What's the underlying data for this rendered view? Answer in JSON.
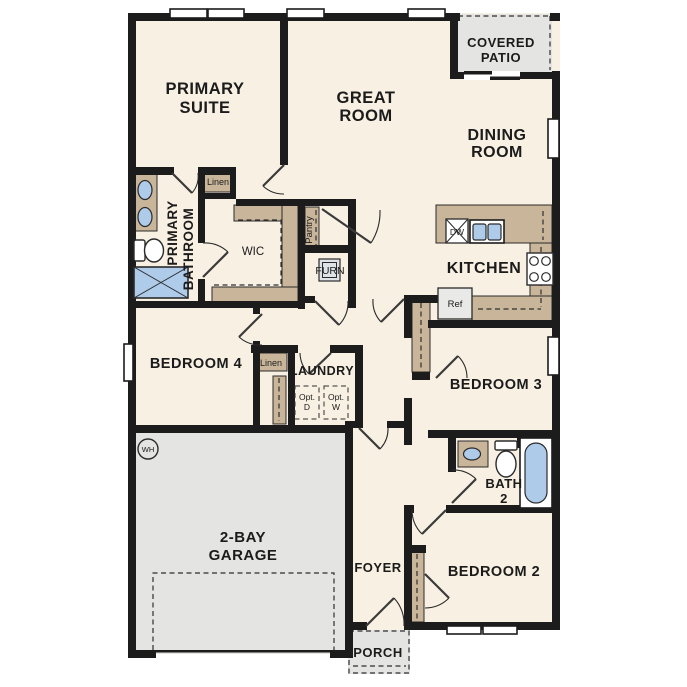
{
  "plan": {
    "type": "single-story residential floor plan",
    "colors": {
      "floor": "#f8f0e3",
      "garage_patio": "#e4e4e2",
      "casework_tan": "#c9b69a",
      "fixture_blue": "#aecbea",
      "wall": "#1c1c1c"
    }
  },
  "rooms": {
    "primary_suite": [
      "PRIMARY",
      "SUITE"
    ],
    "great_room": [
      "GREAT",
      "ROOM"
    ],
    "covered_patio": [
      "COVERED",
      "PATIO"
    ],
    "dining_room": [
      "DINING",
      "ROOM"
    ],
    "primary_bathroom": [
      "PRIMARY",
      "BATHROOM"
    ],
    "wic": "WIC",
    "kitchen": "KITCHEN",
    "bedroom4": "BEDROOM 4",
    "laundry": "LAUNDRY",
    "bedroom3": "BEDROOM 3",
    "bath2": [
      "BATH",
      "2"
    ],
    "bedroom2": "BEDROOM 2",
    "garage": [
      "2-BAY",
      "GARAGE"
    ],
    "foyer": "FOYER",
    "porch": "PORCH"
  },
  "closets": {
    "linen_primary": "Linen",
    "linen_hall": "Linen",
    "pantry": "Pantry"
  },
  "fixtures": {
    "furnace": "FURN",
    "dishwasher": "DW",
    "refrigerator": "Ref",
    "water_heater": "WH",
    "opt_dryer": [
      "Opt.",
      "D"
    ],
    "opt_washer": [
      "Opt.",
      "W"
    ]
  }
}
